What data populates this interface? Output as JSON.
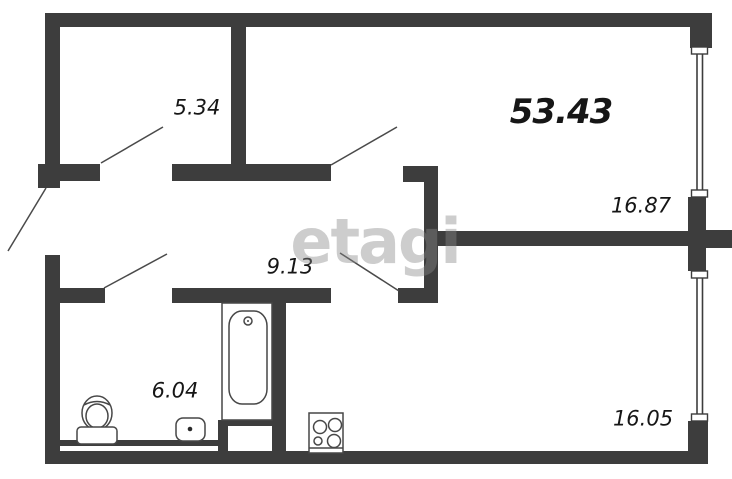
{
  "floorplan": {
    "watermark": "etagi",
    "total_area_label": "53.43",
    "rooms": {
      "storage": {
        "label": "5.34"
      },
      "living": {
        "label": "16.87"
      },
      "hallway": {
        "label": "9.13"
      },
      "bathroom": {
        "label": "6.04"
      },
      "kitchen": {
        "label": "16.05"
      }
    },
    "fixtures": [
      "bathtub-icon",
      "toilet-icon",
      "sink-icon",
      "stove-icon"
    ],
    "features": [
      "window",
      "window",
      "door-swing-lines"
    ],
    "colors": {
      "wall": "#3d3d3d",
      "fixture_line": "#474747",
      "door_line": "#4a4a4a",
      "label_text": "#161616",
      "watermark": "rgba(135,135,135,0.42)",
      "background": "#ffffff"
    }
  }
}
